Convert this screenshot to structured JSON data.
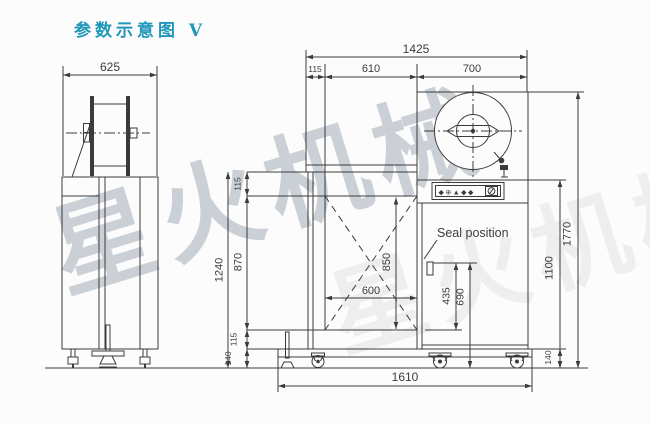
{
  "title": "参数示意图 V",
  "watermark": "星火机械",
  "colors": {
    "title": "#2097ba",
    "line": "#3b3b3b",
    "watermark": "#9aa6b2",
    "bg": "#fcfcfc"
  },
  "side_view": {
    "dims": {
      "overall_width": "625"
    }
  },
  "front_view": {
    "seal_label": "Seal position",
    "panel_glyphs": "◆⊕▲◆◆",
    "dims": {
      "overall_width": "1425",
      "edge_to_arch": "115",
      "arch_span": "610",
      "head_span": "700",
      "beam_height": "115",
      "frame_height": "1240",
      "table_height": "870",
      "arch_width": "600",
      "arch_height": "850",
      "seal_above_base": "435",
      "seal_above_floor": "690",
      "body_height": "1100",
      "overall_height": "1770",
      "base_height": "115",
      "caster_height_left": "140",
      "caster_height_right": "140",
      "base_width": "1610"
    }
  }
}
